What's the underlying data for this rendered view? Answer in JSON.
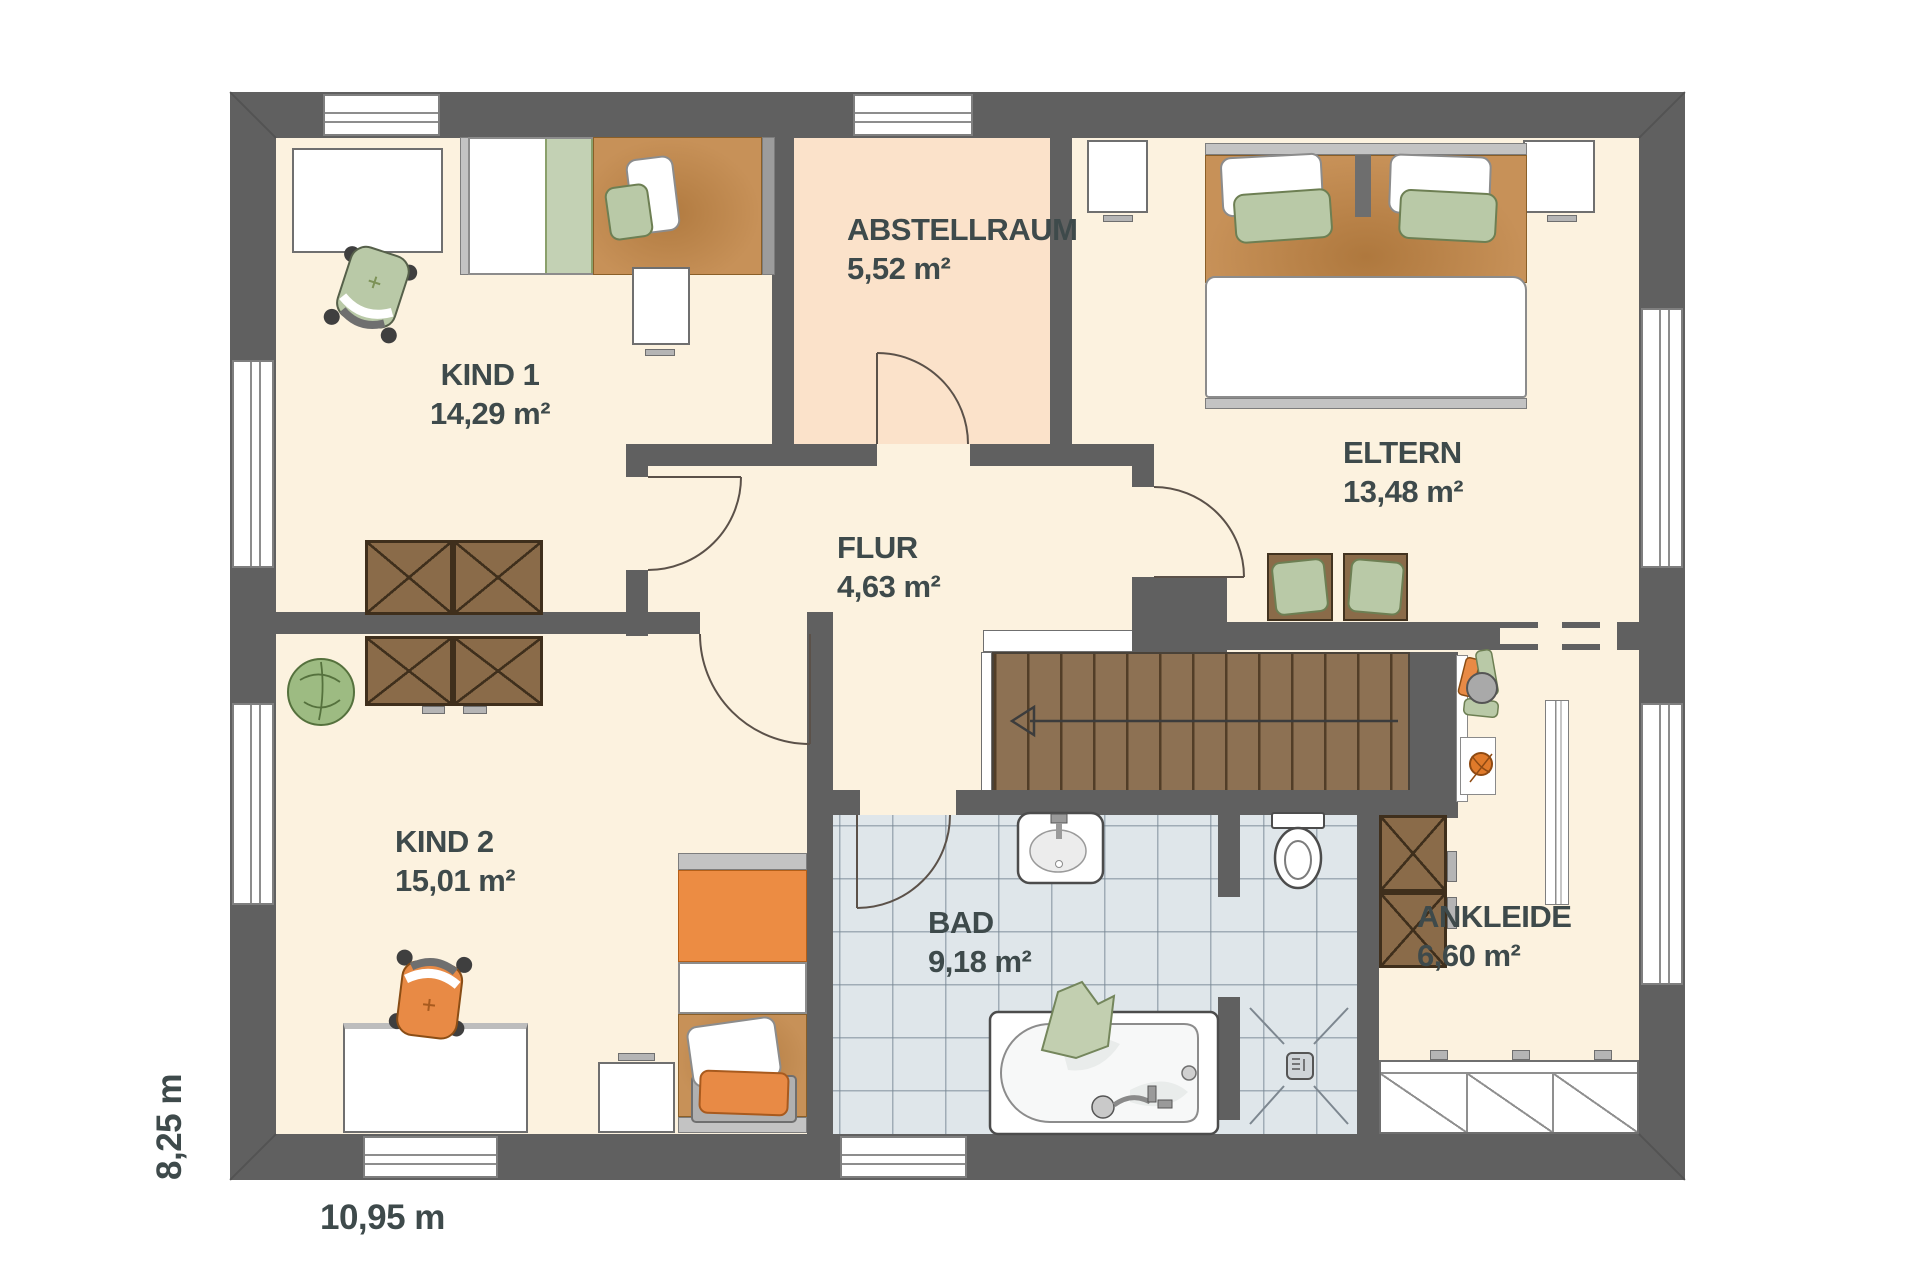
{
  "rooms": {
    "kind1": {
      "name": "KIND 1",
      "area": "14,29 m²"
    },
    "abstellraum": {
      "name": "ABSTELLRAUM",
      "area": "5,52 m²"
    },
    "eltern": {
      "name": "ELTERN",
      "area": "13,48 m²"
    },
    "flur": {
      "name": "FLUR",
      "area": "4,63 m²"
    },
    "kind2": {
      "name": "KIND 2",
      "area": "15,01 m²"
    },
    "bad": {
      "name": "BAD",
      "area": "9,18 m²"
    },
    "ankleide": {
      "name": "ANKLEIDE",
      "area": "6,60 m²"
    }
  },
  "dimensions": {
    "width": "10,95 m",
    "height": "8,25 m"
  },
  "colors": {
    "wall": "#606060",
    "floor": "#fcf2df",
    "storage_floor": "#fbe2ca",
    "tile": "#dfe6ea",
    "stairs_wood": "#8d7153",
    "furniture_wood": "#8a6b49",
    "accent_orange": "#ec8c43",
    "accent_green": "#bccaa6",
    "label_text": "#3e4a4b"
  }
}
